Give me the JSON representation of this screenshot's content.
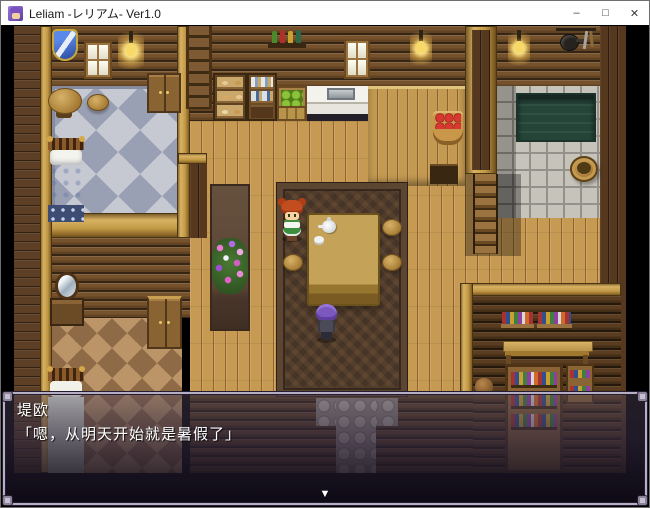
{
  "window": {
    "title": "Leliam -レリアム- Ver1.0",
    "app_icon": "rpg-maker-character-icon",
    "controls": {
      "minimize": "–",
      "maximize": "□",
      "close": "✕"
    }
  },
  "dialogue": {
    "speaker": "堤欧",
    "text": "「嗯，从明天开始就是暑假了」",
    "continue_indicator": "▼"
  },
  "colors": {
    "titlebar_bg": "#ffffff",
    "titlebar_text": "#1a1a1a",
    "game_bg": "#000000",
    "wall_log": "#76522c",
    "floor_wood": "#c79a54",
    "bedroom_carpet": "#c6c8d2",
    "center_carpet": "#463428",
    "bath_water": "#254539",
    "dialogue_frame": "#b6aec2",
    "dialogue_text": "#ffffff"
  }
}
